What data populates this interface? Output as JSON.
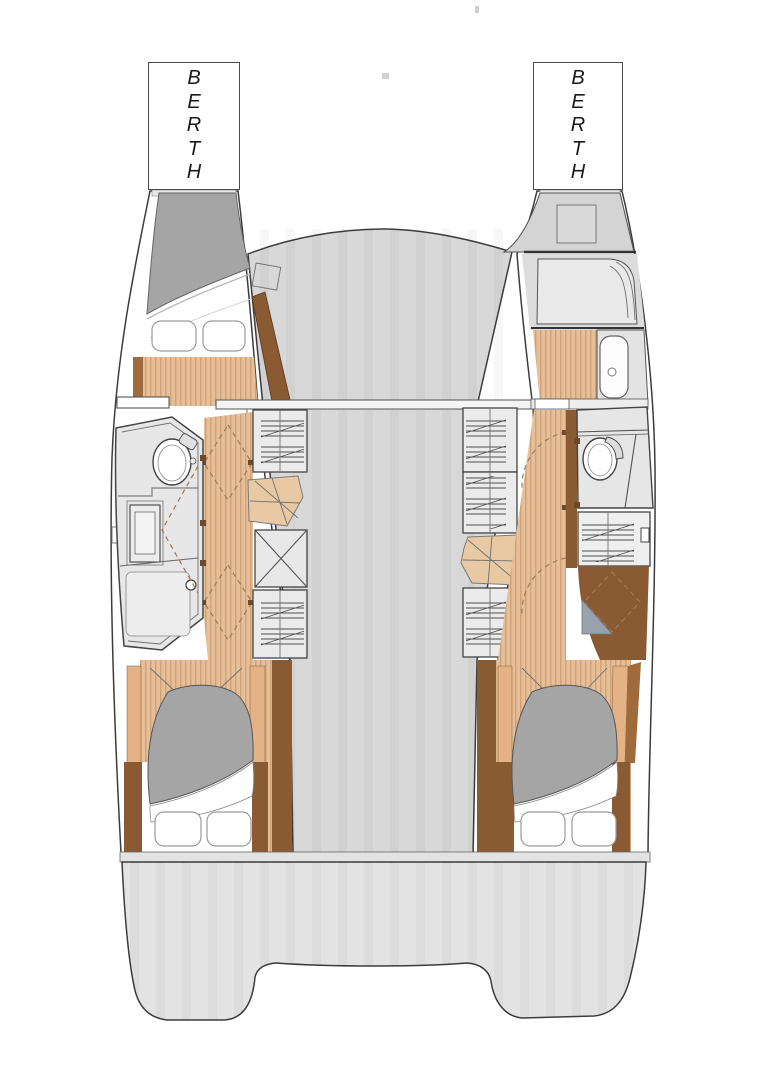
{
  "diagram": {
    "labels": {
      "port_bow_box": "BERTH",
      "starboard_bow_box": "BERTH"
    }
  },
  "colors": {
    "page-bg": "#ffffff",
    "outline-dark": "#3c3c3c",
    "hull-white": "#ffffff",
    "deck-gray": "#d8d8d8",
    "stern-gray": "#e3e3e3",
    "room-gray": "#e7e7e7",
    "unit-gray": "#ebebeb",
    "duvet-gray": "#a5a5a5",
    "wood-base": "#e6bf98",
    "wood-stripe": "#cfa379",
    "stairs-tan": "#e9c9a3",
    "walnut-dark": "#8a5a33",
    "walnut-mid": "#a06b3c",
    "tan-column": "#e3b286",
    "dash-brown": "#9b7d5a",
    "hatch-line": "#4f4f4f",
    "berth-border": "#4a4a4a"
  }
}
